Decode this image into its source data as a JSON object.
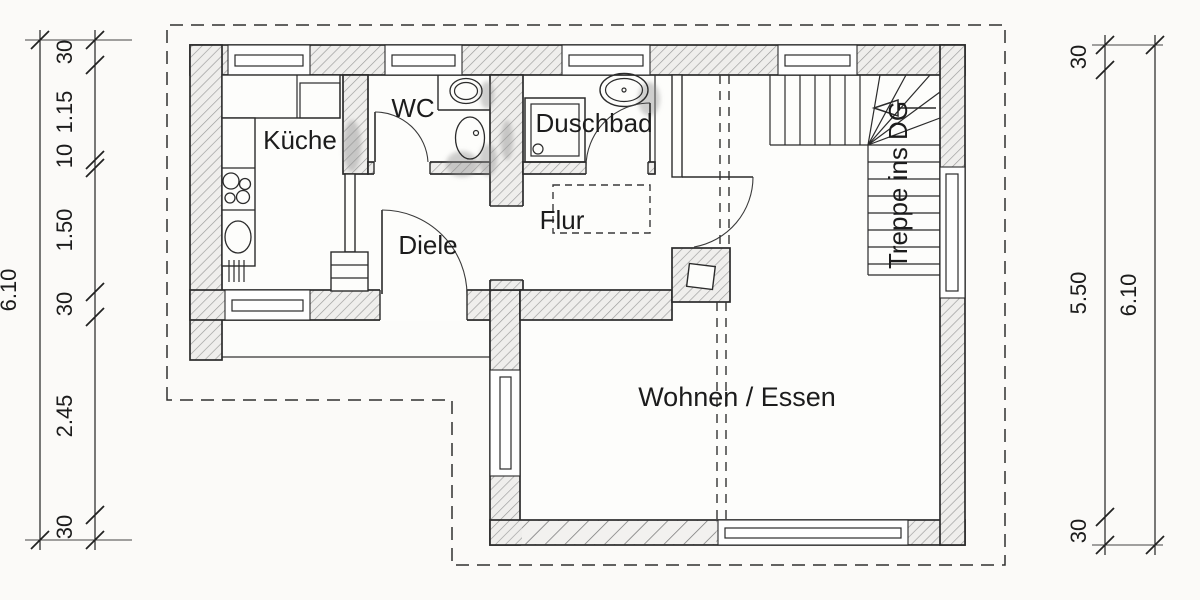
{
  "drawing": {
    "type": "architectural-floor-plan",
    "rooms": {
      "kueche": "Küche",
      "wc": "WC",
      "duschbad": "Duschbad",
      "flur": "Flur",
      "diele": "Diele",
      "wohnen_essen": "Wohnen / Essen",
      "treppe": "Treppe ins DG"
    },
    "dimensions": {
      "left_total": "6.10",
      "left_segments": [
        "30",
        "1.15",
        "10",
        "1.50",
        "30",
        "2.45",
        "30"
      ],
      "right_total": "6.10",
      "right_segments": [
        "30",
        "5.50",
        "30"
      ]
    },
    "colors": {
      "line": "#2b2b2b",
      "hatch": "#9a9a9a",
      "background": "#fbfaf8",
      "shadow": "#8f8f8f"
    }
  }
}
